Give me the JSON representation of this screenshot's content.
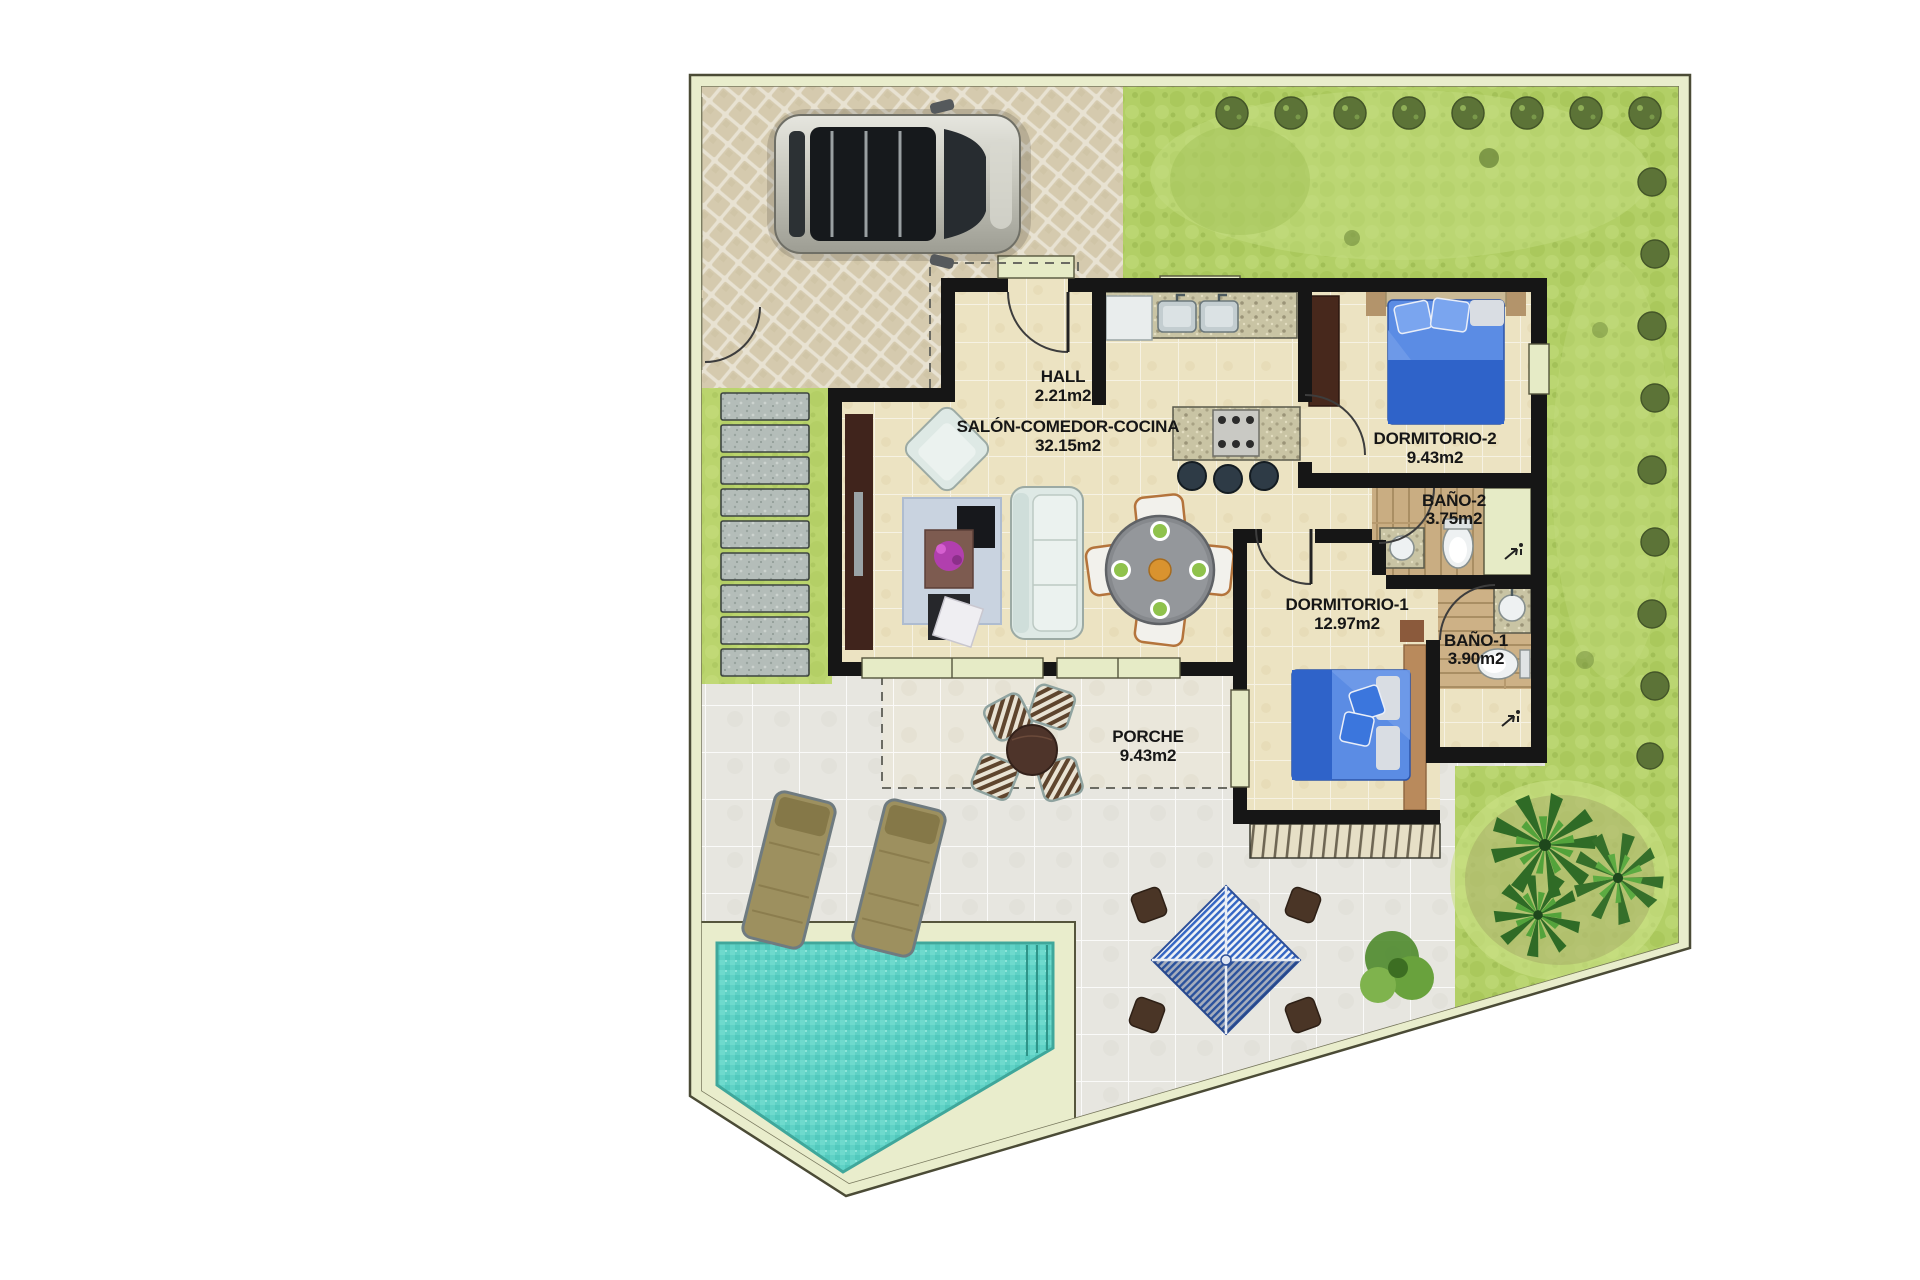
{
  "plan": {
    "type": "floor-plan",
    "rooms": [
      {
        "id": "hall",
        "name": "HALL",
        "area": "2.21m2"
      },
      {
        "id": "salon-comedor-cocina",
        "name": "SALÓN-COMEDOR-COCINA",
        "area": "32.15m2"
      },
      {
        "id": "dormitorio-2",
        "name": "DORMITORIO-2",
        "area": "9.43m2"
      },
      {
        "id": "bano-2",
        "name": "BAÑO-2",
        "area": "3.75m2"
      },
      {
        "id": "dormitorio-1",
        "name": "DORMITORIO-1",
        "area": "12.97m2"
      },
      {
        "id": "bano-1",
        "name": "BAÑO-1",
        "area": "3.90m2"
      },
      {
        "id": "porche",
        "name": "PORCHE",
        "area": "9.43m2"
      }
    ],
    "colors": {
      "plot_band": "#e9edcc",
      "grass": "#b2cf66",
      "driveway": "#d5caae",
      "driveway_joint": "#e8e2d2",
      "terrace": "#e7e6e0",
      "porch_tile": "#eae7db",
      "house_floor": "#ece3c2",
      "wall": "#161616",
      "pool": "#5fd2c6",
      "bed_blanket": "#2f63c9",
      "bed_duvet": "#5b8ce4",
      "wood_floor": "#c9ad82",
      "stone": "#b4bdb9"
    },
    "features": [
      "car",
      "swimming-pool",
      "garden",
      "driveway",
      "terrace",
      "porch-table",
      "sun-loungers",
      "parasol",
      "palm-plants",
      "stepping-stones",
      "kitchen-island",
      "dining-table",
      "sofa",
      "beds"
    ]
  }
}
